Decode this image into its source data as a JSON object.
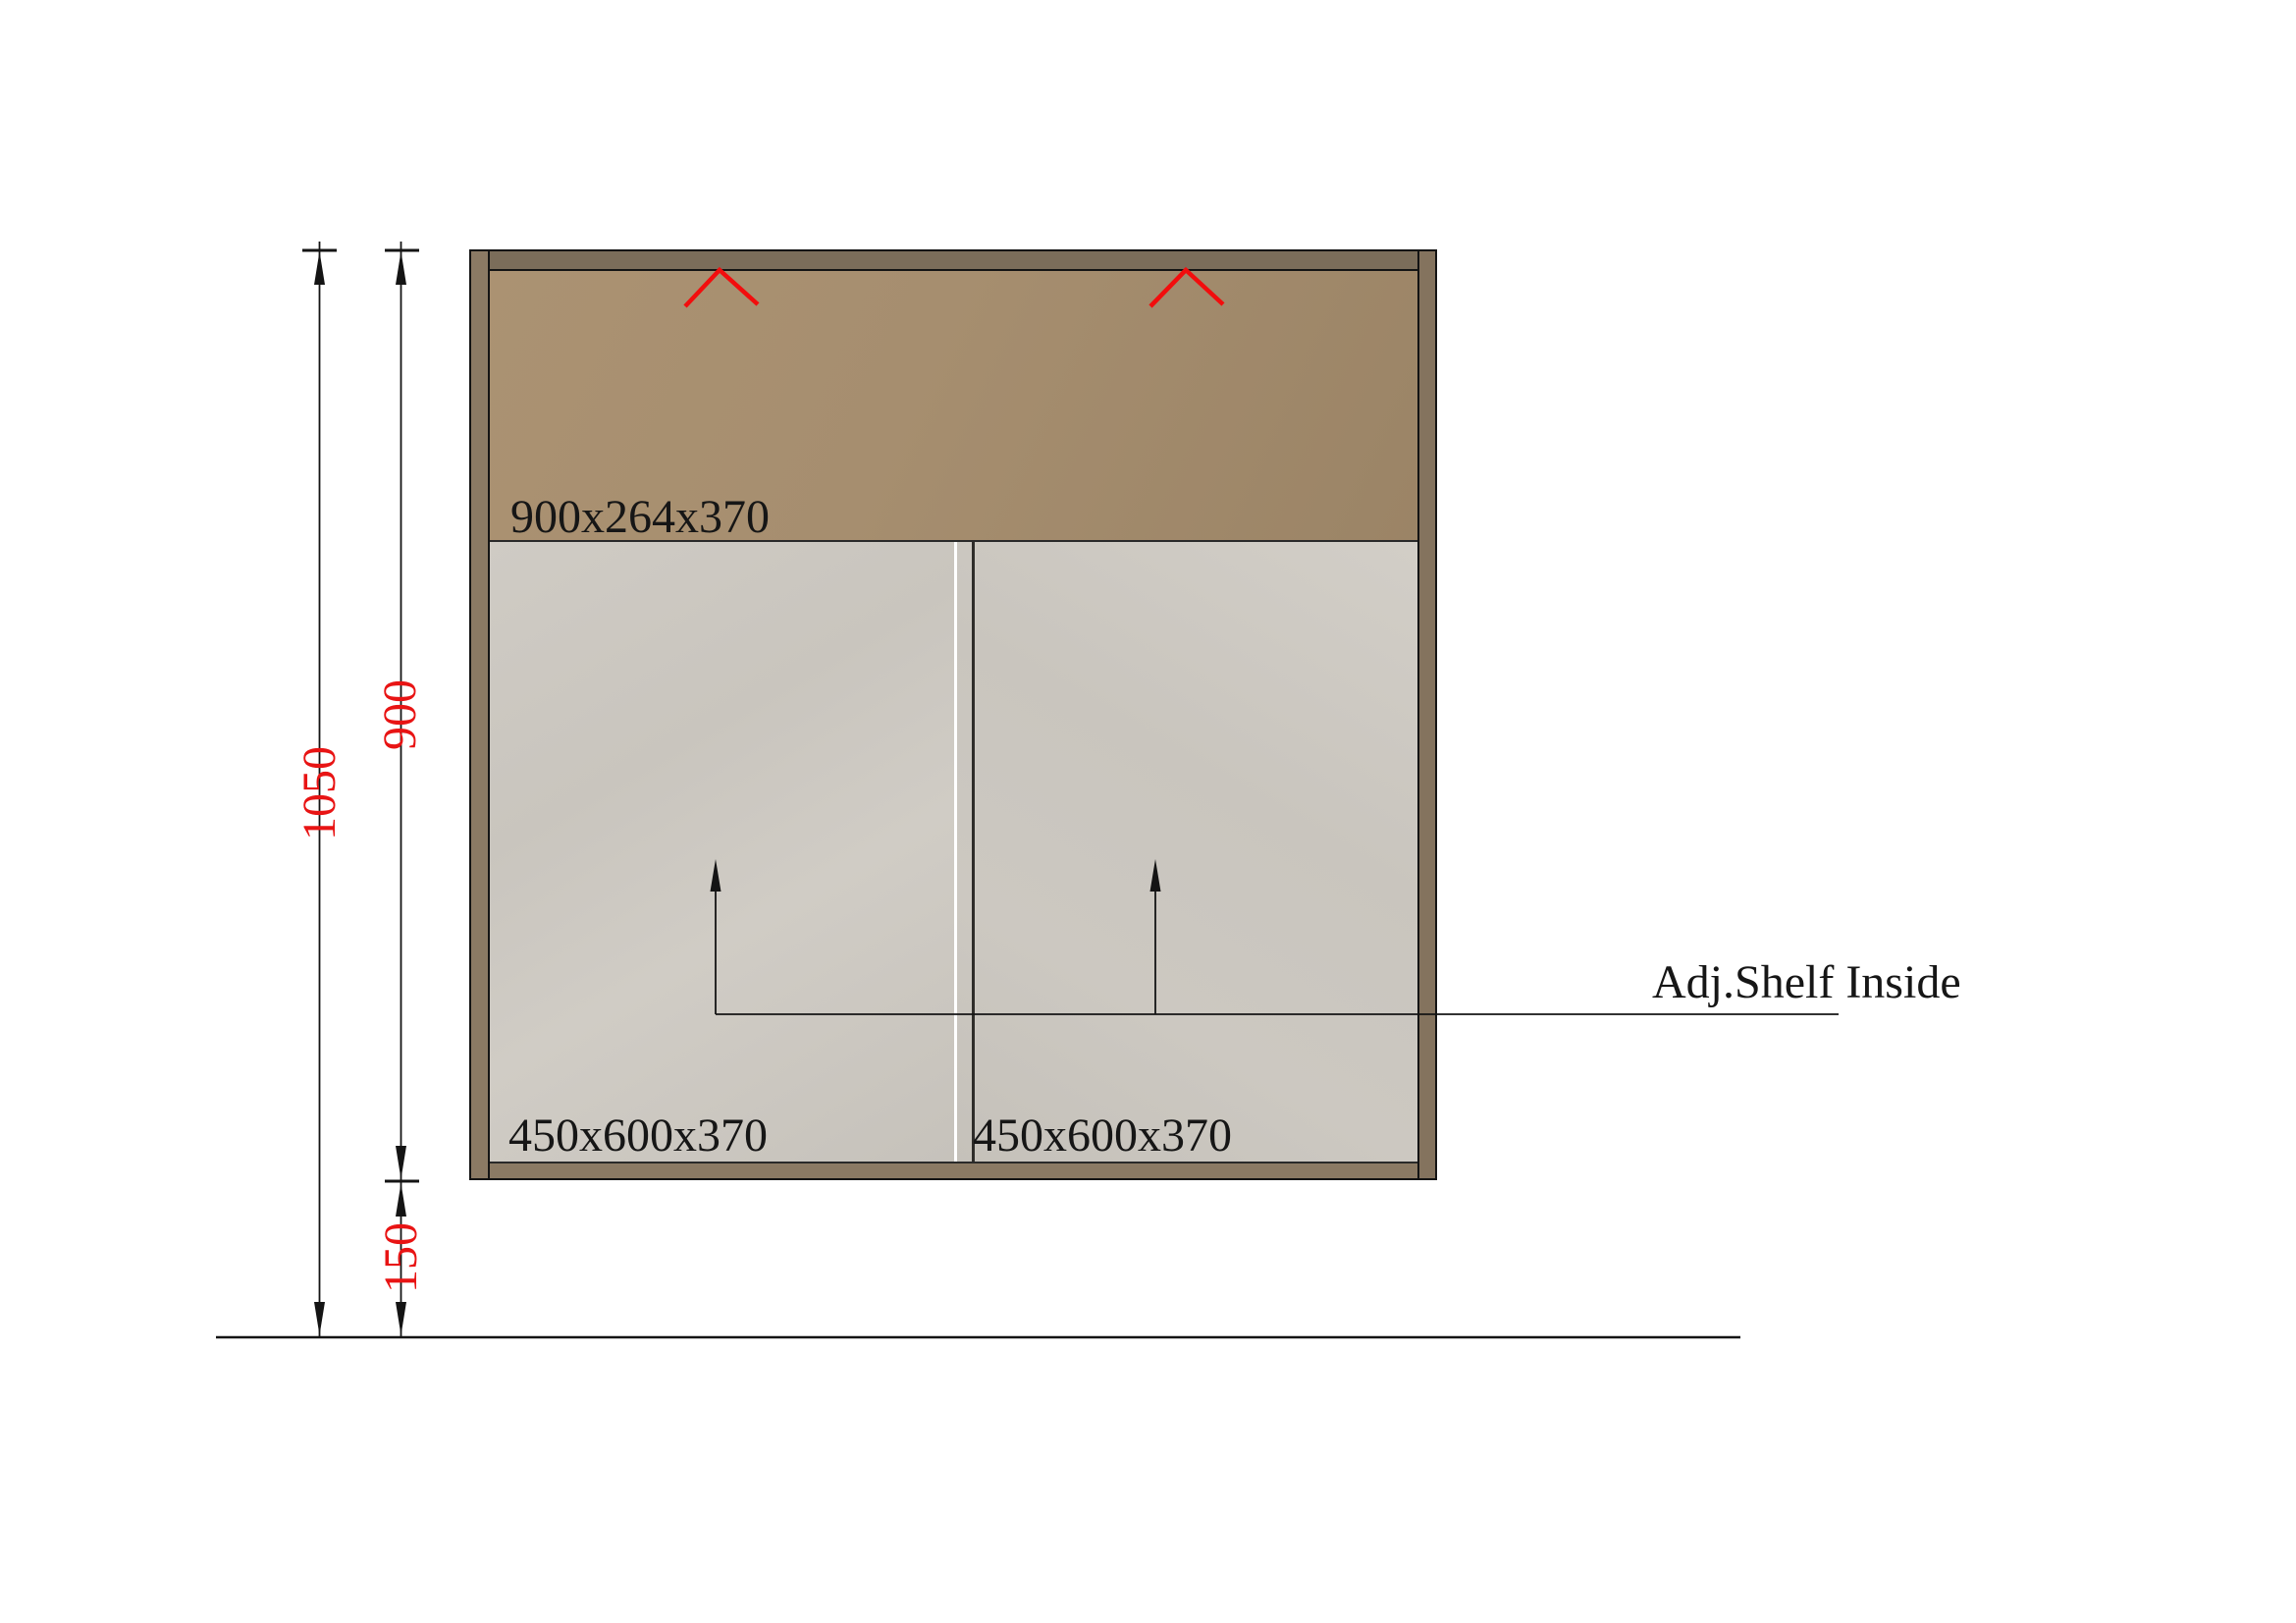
{
  "drawing": {
    "type": "cabinet-elevation",
    "labels": {
      "upper_section": "900x264x370",
      "left_door": "450x600x370",
      "right_door": "450x600x370",
      "shelf_note": "Adj.Shelf Inside"
    },
    "dimensions": {
      "overall_height": "1050",
      "cabinet_height": "900",
      "floor_clearance": "150"
    },
    "colors": {
      "chevron_red": "#f20d0d",
      "dimension_text_red": "#e81414",
      "outline_black": "#141414",
      "top_rail_brown": "#7b6d5a",
      "upper_section_brown": "#a68e6f",
      "side_panel_brown": "#8b7a64",
      "bottom_rail_brown": "#8b7a64",
      "door_grey": "#cac6bf",
      "background": "#ffffff"
    }
  }
}
